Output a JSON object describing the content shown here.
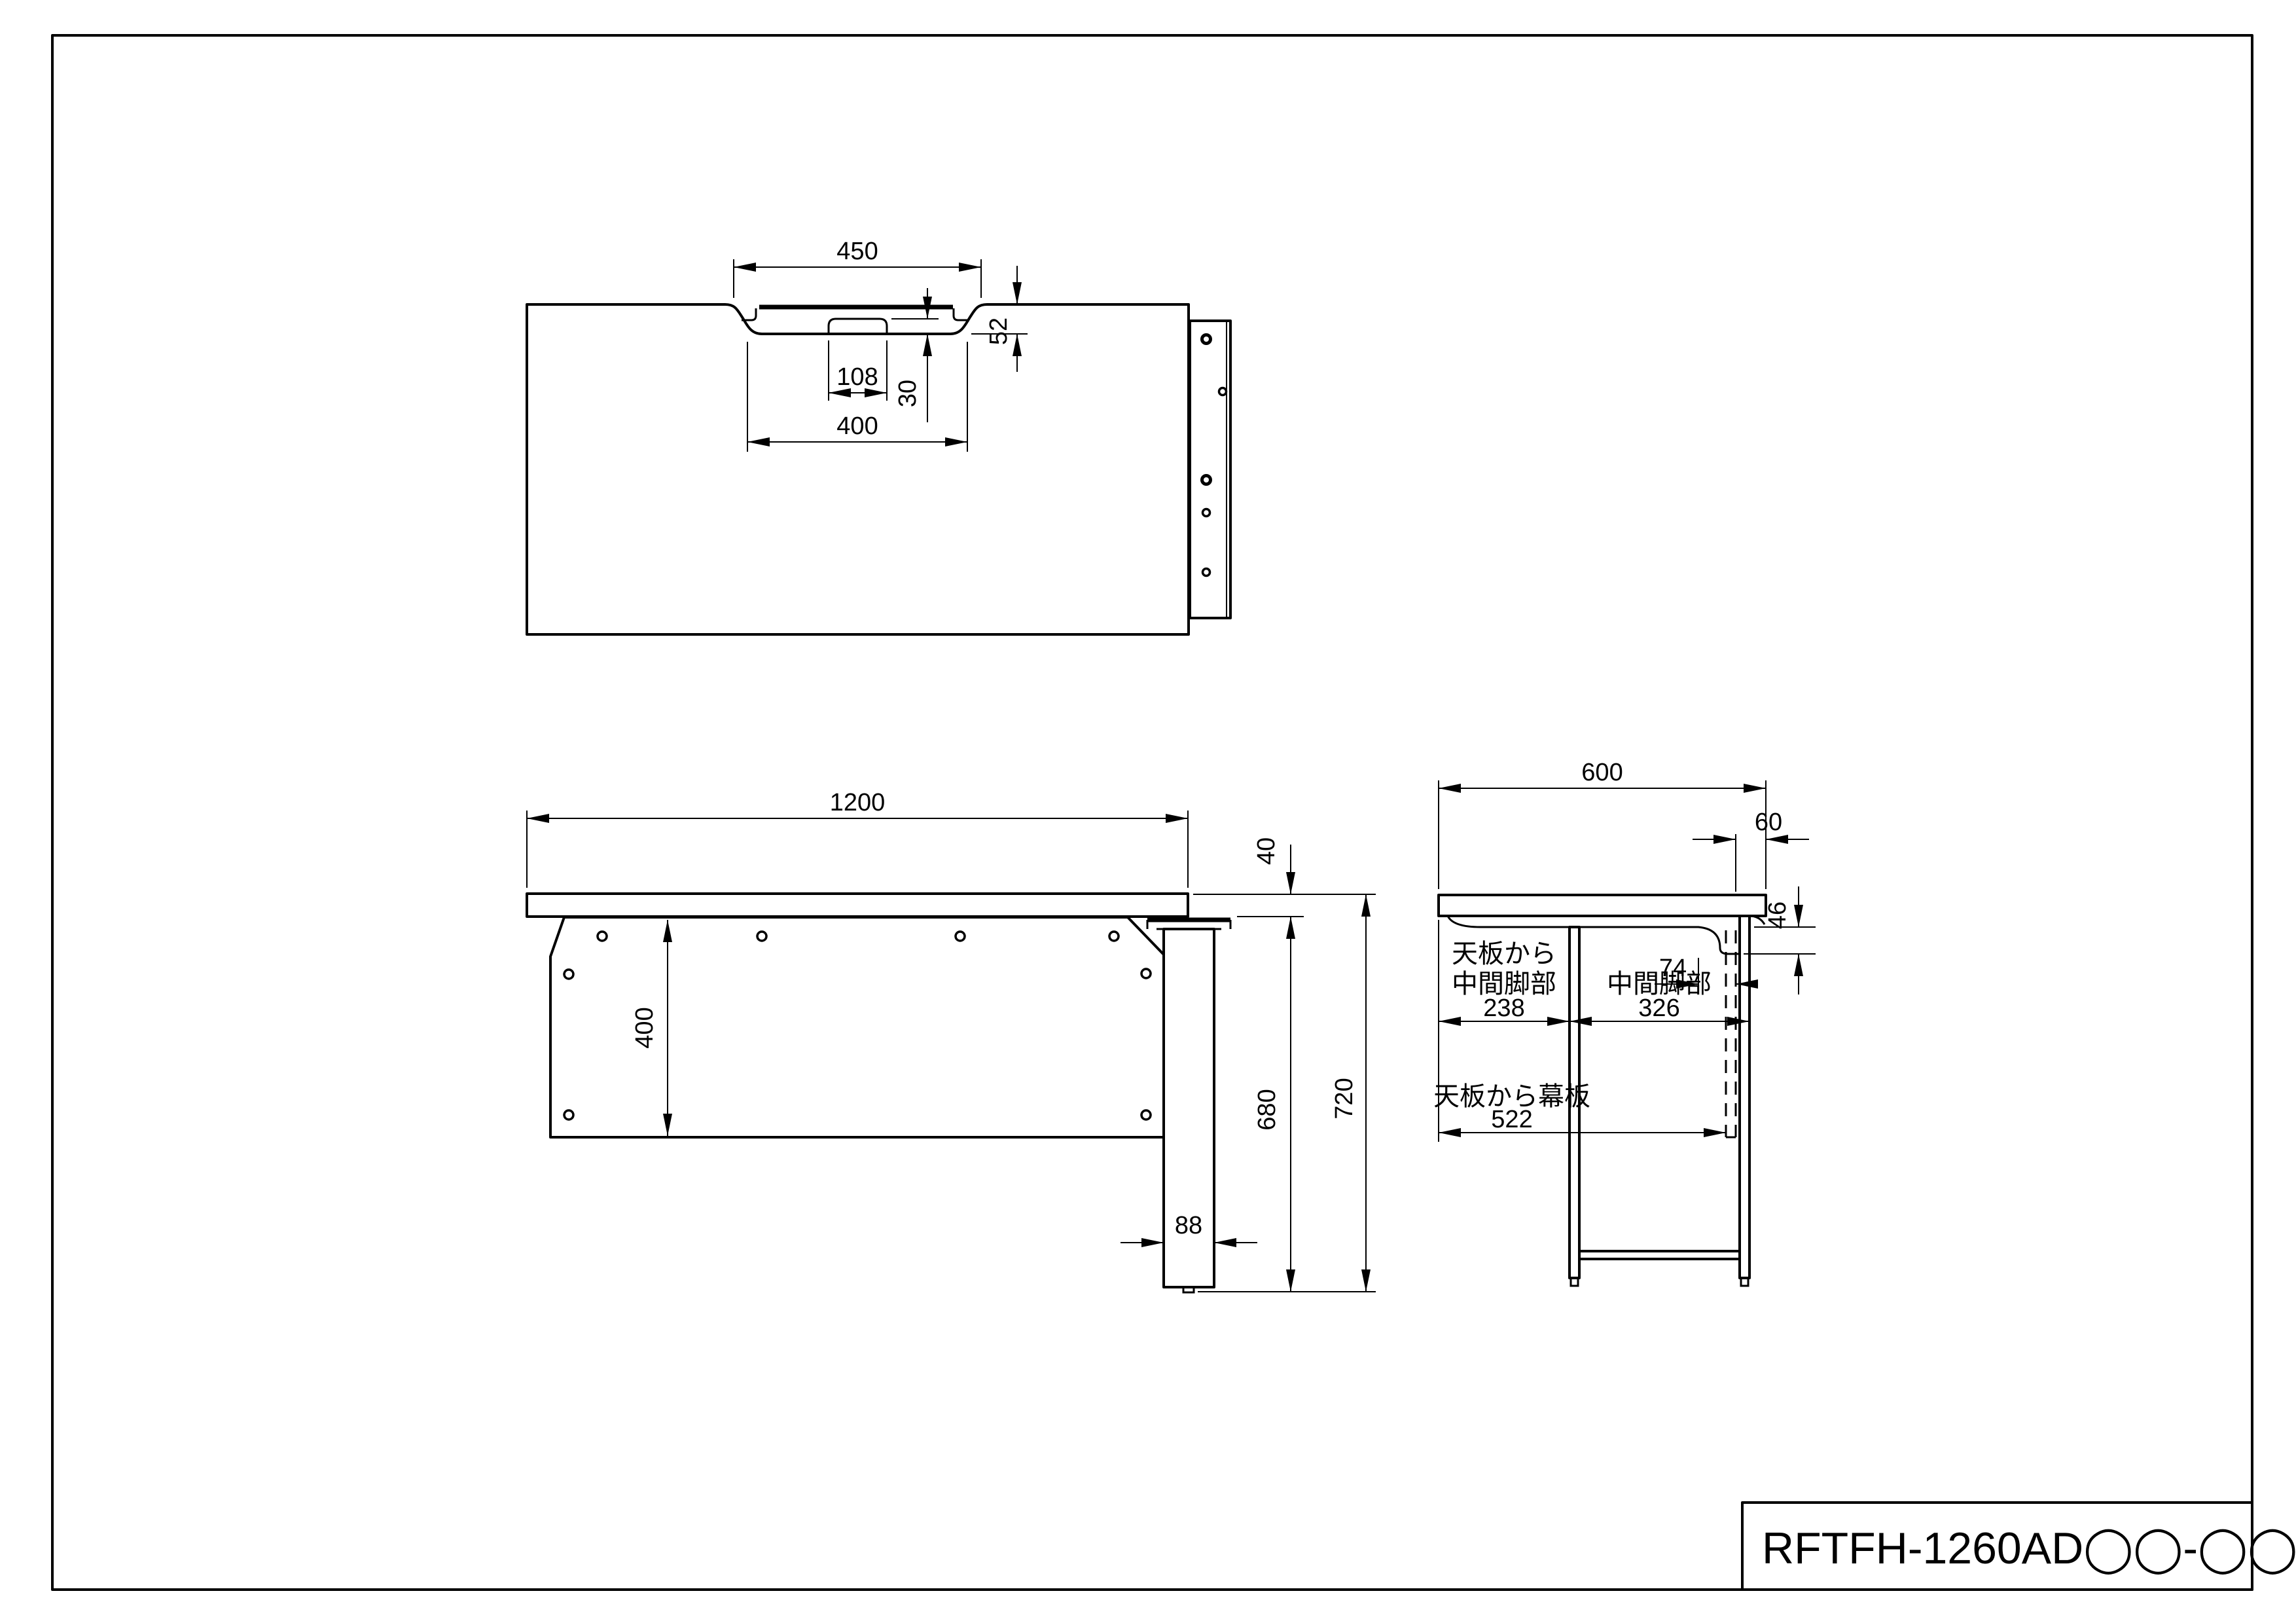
{
  "title_block": {
    "model": "RFTFH-1260AD◯◯-◯◯"
  },
  "views": {
    "top": {
      "dims": {
        "opening": "450",
        "depth": "52",
        "tab": "108",
        "lid": "30",
        "floor": "400"
      }
    },
    "front": {
      "dims": {
        "width": "1200",
        "thickness": "40",
        "panel": "400",
        "leg": "88",
        "under": "680",
        "height": "720"
      }
    },
    "side": {
      "dims": {
        "depth": "600",
        "rear": "60",
        "rail": "46",
        "bracket": "74",
        "leg_front_l1": "天板から",
        "leg_front_l2": "中間脚部",
        "leg_front": "238",
        "leg_span_l1": "中間脚部",
        "leg_span": "326",
        "panel_l1": "天板から幕板",
        "panel": "522"
      }
    }
  }
}
